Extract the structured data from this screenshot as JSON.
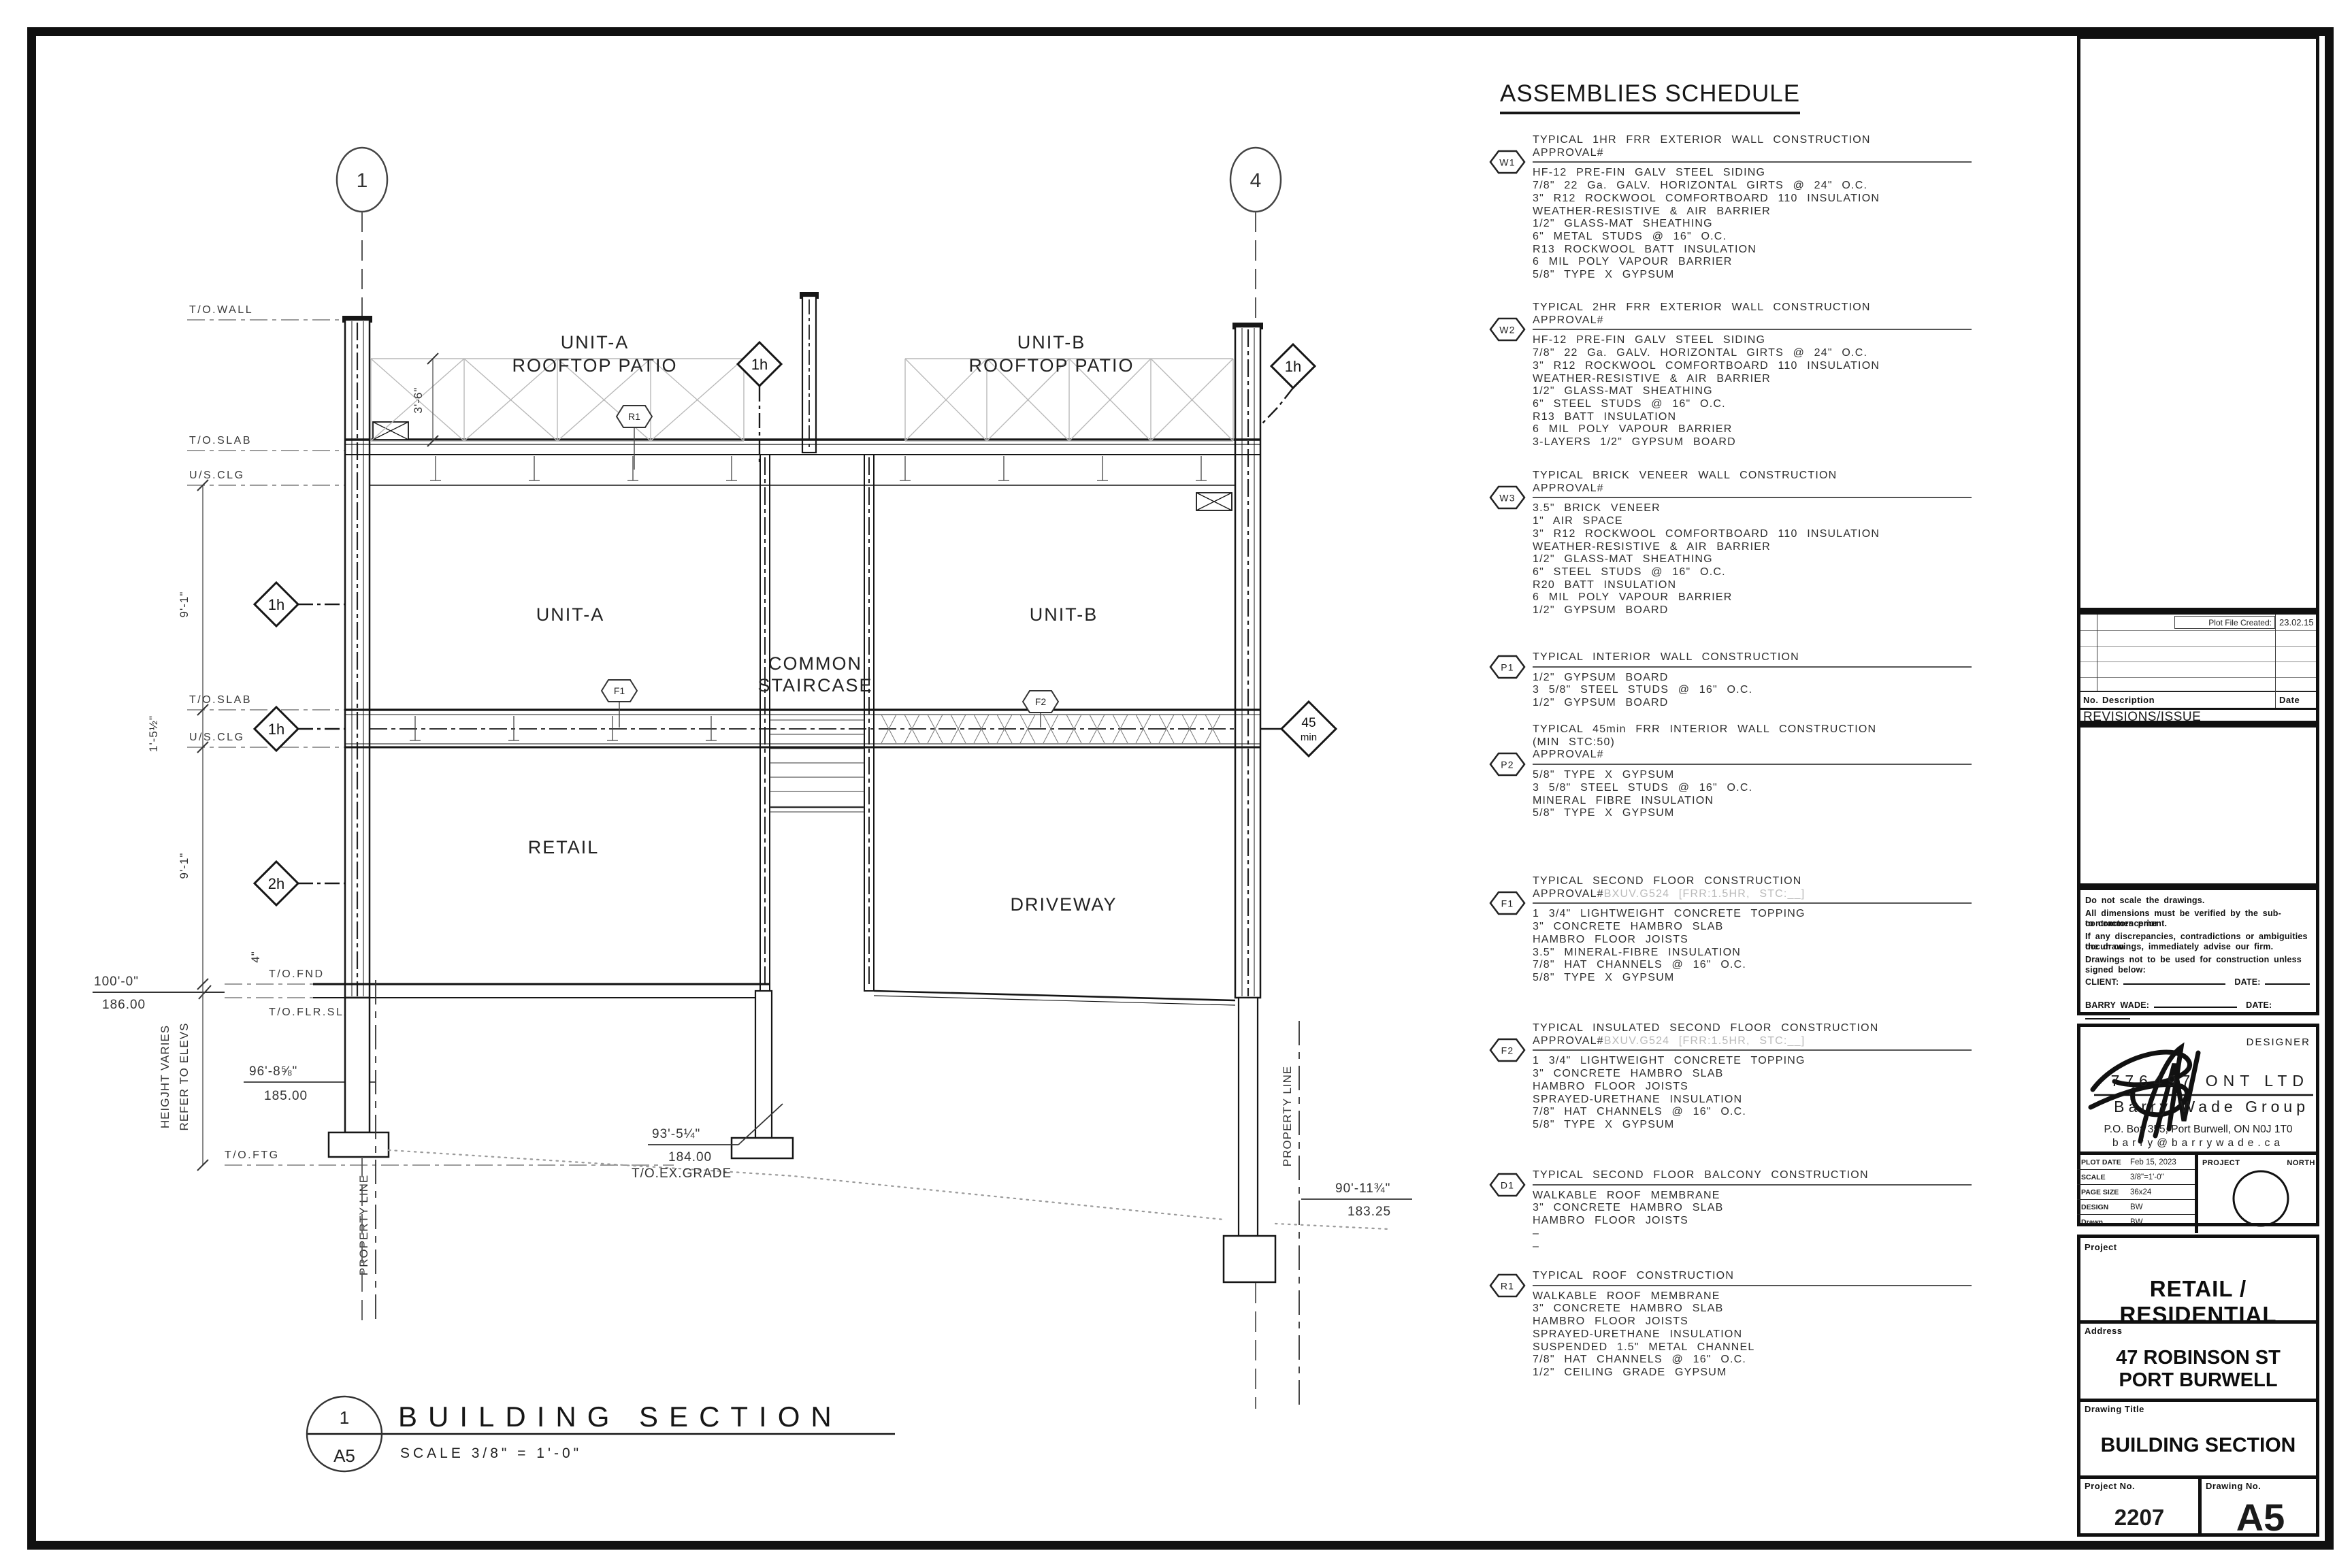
{
  "schedule": {
    "title": "ASSEMBLIES SCHEDULE",
    "blocks": [
      {
        "tag": "W1",
        "title": "TYPICAL 1HR FRR EXTERIOR WALL CONSTRUCTION",
        "approval": "APPROVAL#",
        "approval_ref": "",
        "items": [
          "HF-12 PRE-FIN GALV STEEL SIDING",
          "7/8\" 22 Ga. GALV. HORIZONTAL GIRTS @ 24\" O.C.",
          "3\" R12 ROCKWOOL COMFORTBOARD 110 INSULATION",
          "WEATHER-RESISTIVE & AIR BARRIER",
          "1/2\" GLASS-MAT SHEATHING",
          "6\" METAL STUDS @ 16\" O.C.",
          "R13 ROCKWOOL BATT INSULATION",
          "6 MIL POLY VAPOUR BARRIER",
          "5/8\" TYPE X GYPSUM"
        ]
      },
      {
        "tag": "W2",
        "title": "TYPICAL 2HR FRR EXTERIOR WALL CONSTRUCTION",
        "approval": "APPROVAL#",
        "approval_ref": "",
        "items": [
          "HF-12 PRE-FIN GALV STEEL SIDING",
          "7/8\" 22 Ga. GALV. HORIZONTAL GIRTS @ 24\" O.C.",
          "3\" R12 ROCKWOOL COMFORTBOARD 110 INSULATION",
          "WEATHER-RESISTIVE & AIR BARRIER",
          "1/2\" GLASS-MAT SHEATHING",
          "6\" STEEL STUDS @ 16\" O.C.",
          "R13 BATT INSULATION",
          "6 MIL POLY VAPOUR BARRIER",
          "3-LAYERS 1/2\" GYPSUM BOARD"
        ]
      },
      {
        "tag": "W3",
        "title": "TYPICAL BRICK VENEER WALL CONSTRUCTION",
        "approval": "APPROVAL#",
        "approval_ref": "",
        "items": [
          "3.5\" BRICK VENEER",
          "1\" AIR SPACE",
          "3\" R12 ROCKWOOL COMFORTBOARD 110 INSULATION",
          "WEATHER-RESISTIVE & AIR BARRIER",
          "1/2\" GLASS-MAT SHEATHING",
          "6\" STEEL STUDS @ 16\" O.C.",
          "R20 BATT INSULATION",
          "6 MIL POLY VAPOUR BARRIER",
          "1/2\" GYPSUM BOARD"
        ]
      },
      {
        "tag": "P1",
        "title": "TYPICAL INTERIOR WALL CONSTRUCTION",
        "approval": "",
        "approval_ref": "",
        "items": [
          "1/2\" GYPSUM BOARD",
          "3 5/8\" STEEL STUDS @ 16\" O.C.",
          "1/2\" GYPSUM BOARD"
        ]
      },
      {
        "tag": "P2",
        "title": "TYPICAL 45min FRR INTERIOR WALL CONSTRUCTION",
        "title2": "(MIN STC:50)",
        "approval": "APPROVAL#",
        "approval_ref": "",
        "items": [
          "5/8\" TYPE X GYPSUM",
          "3 5/8\" STEEL STUDS @ 16\" O.C.",
          "MINERAL FIBRE INSULATION",
          "5/8\" TYPE X GYPSUM"
        ]
      },
      {
        "tag": "F1",
        "title": "TYPICAL SECOND FLOOR CONSTRUCTION",
        "approval": "APPROVAL#",
        "approval_ref": "BXUV.G524 [FRR:1.5HR, STC:__]",
        "items": [
          "1 3/4\" LIGHTWEIGHT CONCRETE TOPPING",
          "3\" CONCRETE HAMBRO SLAB",
          "HAMBRO FLOOR JOISTS",
          "3.5\" MINERAL-FIBRE INSULATION",
          "7/8\" HAT CHANNELS @ 16\" O.C.",
          "5/8\" TYPE X GYPSUM"
        ]
      },
      {
        "tag": "F2",
        "title": "TYPICAL INSULATED SECOND FLOOR CONSTRUCTION",
        "approval": "APPROVAL#",
        "approval_ref": "BXUV.G524 [FRR:1.5HR, STC:__]",
        "items": [
          "1 3/4\" LIGHTWEIGHT CONCRETE TOPPING",
          "3\" CONCRETE HAMBRO SLAB",
          "HAMBRO FLOOR JOISTS",
          "SPRAYED-URETHANE INSULATION",
          "7/8\" HAT CHANNELS @ 16\" O.C.",
          "5/8\" TYPE X GYPSUM"
        ]
      },
      {
        "tag": "D1",
        "title": "TYPICAL SECOND FLOOR BALCONY CONSTRUCTION",
        "approval": "",
        "approval_ref": "",
        "items": [
          "WALKABLE ROOF MEMBRANE",
          "3\" CONCRETE HAMBRO SLAB",
          "HAMBRO FLOOR JOISTS",
          "–",
          "–"
        ]
      },
      {
        "tag": "R1",
        "title": "TYPICAL ROOF CONSTRUCTION",
        "approval": "",
        "approval_ref": "",
        "items": [
          "WALKABLE ROOF MEMBRANE",
          "3\" CONCRETE HAMBRO SLAB",
          "HAMBRO FLOOR JOISTS",
          "SPRAYED-URETHANE INSULATION",
          "SUSPENDED 1.5\" METAL CHANNEL",
          "7/8\" HAT CHANNELS @ 16\" O.C.",
          "1/2\" CEILING GRADE GYPSUM"
        ]
      }
    ]
  },
  "drawing": {
    "grid": {
      "b1": "1",
      "b4": "4"
    },
    "levels": {
      "towall": "T/O.WALL",
      "toslab": "T/O.SLAB",
      "usclg": "U/S.CLG",
      "toslab2": "T/O.SLAB",
      "usclg2": "U/S.CLG",
      "tofnd": "T/O.FND",
      "toflrslab": "T/O.FLR.SLAB",
      "toftg": "T/O.FTG",
      "toexgrade": "T/O.EX.GRADE"
    },
    "elevations": {
      "l100": "100'-0\"",
      "m186": "186.00",
      "l96": "96'-8⅝\"",
      "m185": "185.00",
      "l93": "93'-5¼\"",
      "m184": "184.00",
      "l90": "90'-11¾\"",
      "m183": "183.25"
    },
    "dims": {
      "d91a": "9'-1\"",
      "d152": "1'-5½\"",
      "d91b": "9'-1\"",
      "d36": "3'-6\"",
      "d4": "4\"",
      "hv1": "HEIGJHT VARIES",
      "hv2": "REFER TO ELEVS"
    },
    "rooms": {
      "ua1": "UNIT-A",
      "ua2": "ROOFTOP PATIO",
      "ub1": "UNIT-B",
      "ub2": "ROOFTOP PATIO",
      "unita": "UNIT-A",
      "unitb": "UNIT-B",
      "cs1": "COMMON",
      "cs2": "STAIRCASE",
      "retail": "RETAIL",
      "driveway": "DRIVEWAY"
    },
    "tags": {
      "t1h": "1h",
      "t2h": "2h",
      "t45a": "45",
      "t45b": "min",
      "r1": "R1",
      "f1": "F1",
      "f2": "F2"
    },
    "property_line": "PROPERTY LINE",
    "title": {
      "num": "1",
      "sheet": "A5",
      "label": "BUILDING SECTION",
      "scale": "SCALE 3/8\" = 1'-0\""
    }
  },
  "titleblock": {
    "revisions": {
      "plot_file_created": "Plot File Created:",
      "date": "23.02.15",
      "col_no": "No.",
      "col_desc": "Description",
      "col_date": "Date",
      "label": "REVISIONS/ISSUE"
    },
    "notes": {
      "l1": "Do not scale the drawings.",
      "l2": "All dimensions must be verified by the sub-contractors prior",
      "l3": "to commencement.",
      "l4": "If any discrepancies, contradictions or ambiguities occur on",
      "l5": "the drawings, immediately advise our firm.",
      "l6": "Drawings not to be used for construction unless signed below:",
      "client": "CLIENT:",
      "barry": "BARRY WADE:",
      "date": "DATE:"
    },
    "designer": {
      "label": "DESIGNER",
      "company": "776497 ONT LTD",
      "group": "Barry Wade Group",
      "address": "P.O. Box 355, Port Burwell, ON  N0J 1T0",
      "email": "barry@barrywade.ca"
    },
    "plot": {
      "l1": "PLOT DATE",
      "v1": "Feb 15, 2023",
      "l2": "SCALE",
      "v2": "3/8\"=1'-0\"",
      "l3": "PAGE SIZE",
      "v3": "36x24",
      "l4": "DESIGN",
      "v4": "BW",
      "l5": "Drawn",
      "v5": "BW",
      "project": "PROJECT",
      "north": "NORTH"
    },
    "project_label": "Project",
    "project": "RETAIL / RESIDENTIAL",
    "address_label": "Address",
    "address1": "47 ROBINSON ST",
    "address2": "PORT BURWELL",
    "title_label": "Drawing Title",
    "title": "BUILDING SECTION",
    "pno_label": "Project No.",
    "pno": "2207",
    "dno_label": "Drawing No.",
    "dno": "A5"
  }
}
